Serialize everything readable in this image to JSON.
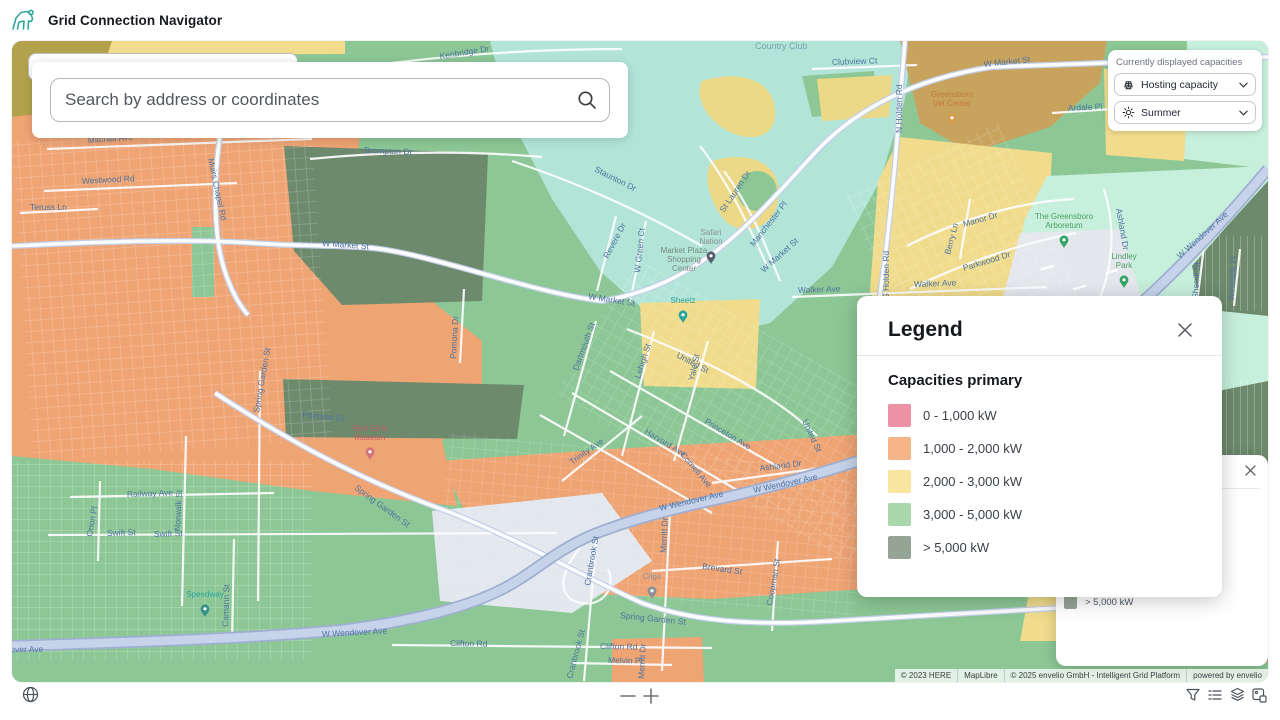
{
  "header": {
    "title": "Grid Connection Navigator",
    "brand_color": "#2fa99e"
  },
  "search": {
    "placeholder": "Search by address or coordinates"
  },
  "capacity_panel": {
    "label": "Currently displayed capacities",
    "dropdowns": [
      {
        "icon": "solar-panel-icon",
        "label": "Hosting capacity"
      },
      {
        "icon": "sun-icon",
        "label": "Summer"
      }
    ]
  },
  "legend": {
    "title": "Legend",
    "section": "Capacities primary",
    "items": [
      {
        "label": "0 - 1,000 kW",
        "color": "#ec92a4"
      },
      {
        "label": "1,000 - 2,000 kW",
        "color": "#f6b588"
      },
      {
        "label": "2,000 - 3,000 kW",
        "color": "#f8e69e"
      },
      {
        "label": "3,000 - 5,000 kW",
        "color": "#a9d8ac"
      },
      {
        "label": "> 5,000 kW",
        "color": "#96a496"
      }
    ]
  },
  "legend_back": {
    "item": {
      "label": "> 5,000 kW",
      "color": "#96a496"
    }
  },
  "attribution": {
    "items": [
      "© 2023 HERE",
      "MapLibre",
      "© 2025 envelio GmbH - Intelligent Grid Platform",
      "powered by envelio"
    ]
  },
  "map": {
    "road_labels": [
      {
        "t": "Mitchell Ave",
        "x": 76,
        "y": 102,
        "r": -4
      },
      {
        "t": "Westwood Rd",
        "x": 70,
        "y": 143,
        "r": -3
      },
      {
        "t": "Teruss Ln",
        "x": 18,
        "y": 169,
        "r": 0
      },
      {
        "t": "Muirs Chapel Rd",
        "x": 196,
        "y": 118,
        "r": 78
      },
      {
        "t": "Brompton Dr",
        "x": 352,
        "y": 112,
        "r": 2
      },
      {
        "t": "Kenbridge Dr",
        "x": 428,
        "y": 18,
        "r": -9
      },
      {
        "t": "Clubview Ct",
        "x": 820,
        "y": 24,
        "r": -2
      },
      {
        "t": "N Holden Rd",
        "x": 890,
        "y": 92,
        "r": -90
      },
      {
        "t": "S Holden Rd",
        "x": 877,
        "y": 258,
        "r": -90
      },
      {
        "t": "W Market St",
        "x": 310,
        "y": 205,
        "r": 4
      },
      {
        "t": "W Market St",
        "x": 576,
        "y": 258,
        "r": 9
      },
      {
        "t": "W Market St",
        "x": 752,
        "y": 232,
        "r": -42
      },
      {
        "t": "W Market St",
        "x": 972,
        "y": 26,
        "r": -6
      },
      {
        "t": "Staunton Dr",
        "x": 582,
        "y": 130,
        "r": 27
      },
      {
        "t": "St Lauren Dr",
        "x": 712,
        "y": 172,
        "r": -56
      },
      {
        "t": "Manchester Pl",
        "x": 742,
        "y": 206,
        "r": -52
      },
      {
        "t": "Walker Ave",
        "x": 786,
        "y": 252,
        "r": -2
      },
      {
        "t": "Walker Ave",
        "x": 902,
        "y": 246,
        "r": -2
      },
      {
        "t": "Ardale Pl",
        "x": 1056,
        "y": 70,
        "r": -3
      },
      {
        "t": "Manor Dr",
        "x": 952,
        "y": 186,
        "r": -16
      },
      {
        "t": "Parkwood Dr",
        "x": 952,
        "y": 230,
        "r": -17
      },
      {
        "t": "Berry Ln",
        "x": 938,
        "y": 214,
        "r": -75
      },
      {
        "t": "Ashland Dr",
        "x": 1104,
        "y": 168,
        "r": 80
      },
      {
        "t": "Ashland Dr",
        "x": 748,
        "y": 430,
        "r": -7
      },
      {
        "t": "W Wendover Ave",
        "x": 1168,
        "y": 218,
        "r": -42
      },
      {
        "t": "W Wendover Ave",
        "x": 742,
        "y": 452,
        "r": -12
      },
      {
        "t": "W Wendover Ave",
        "x": 648,
        "y": 470,
        "r": -13
      },
      {
        "t": "W Wendover Ave",
        "x": 310,
        "y": 596,
        "r": -3
      },
      {
        "t": "W Wendover Ave",
        "x": -34,
        "y": 612,
        "r": -1
      },
      {
        "t": "Spring Garden St",
        "x": 247,
        "y": 372,
        "r": -80
      },
      {
        "t": "Spring Garden St",
        "x": 342,
        "y": 448,
        "r": 36
      },
      {
        "t": "Spring Garden St",
        "x": 608,
        "y": 577,
        "r": 6
      },
      {
        "t": "Pomona Dr",
        "x": 444,
        "y": 318,
        "r": -87
      },
      {
        "t": "Pomona Dr",
        "x": 290,
        "y": 376,
        "r": 6
      },
      {
        "t": "Railway Ave",
        "x": 115,
        "y": 456,
        "r": -2
      },
      {
        "t": "Swift St",
        "x": 95,
        "y": 495,
        "r": -2
      },
      {
        "t": "Swift St",
        "x": 142,
        "y": 496,
        "r": -2
      },
      {
        "t": "Norwalk St",
        "x": 168,
        "y": 490,
        "r": -87
      },
      {
        "t": "Orion Pl",
        "x": 80,
        "y": 496,
        "r": -80
      },
      {
        "t": "Camann St",
        "x": 216,
        "y": 586,
        "r": -88
      },
      {
        "t": "United St",
        "x": 664,
        "y": 316,
        "r": 28
      },
      {
        "t": "United St",
        "x": 790,
        "y": 380,
        "r": 65
      },
      {
        "t": "Princeton Ave",
        "x": 692,
        "y": 382,
        "r": 31
      },
      {
        "t": "Harvard Ave",
        "x": 632,
        "y": 392,
        "r": 31
      },
      {
        "t": "Cornell Ave",
        "x": 668,
        "y": 414,
        "r": 50
      },
      {
        "t": "Lehigh St",
        "x": 628,
        "y": 338,
        "r": -72
      },
      {
        "t": "Yale St",
        "x": 682,
        "y": 340,
        "r": -78
      },
      {
        "t": "Dartmouth St",
        "x": 566,
        "y": 330,
        "r": -70
      },
      {
        "t": "Trinity Ave",
        "x": 560,
        "y": 424,
        "r": -35
      },
      {
        "t": "Merritt Dr",
        "x": 654,
        "y": 512,
        "r": -87
      },
      {
        "t": "Merritt Dr",
        "x": 632,
        "y": 638,
        "r": -87
      },
      {
        "t": "Brevard St",
        "x": 690,
        "y": 528,
        "r": 8
      },
      {
        "t": "Coopman St",
        "x": 760,
        "y": 565,
        "r": -80
      },
      {
        "t": "Cranbrook St",
        "x": 578,
        "y": 545,
        "r": -80
      },
      {
        "t": "Cranbrook St",
        "x": 560,
        "y": 638,
        "r": -75
      },
      {
        "t": "Clifton Rd",
        "x": 438,
        "y": 605,
        "r": 1
      },
      {
        "t": "Clifton Rd",
        "x": 588,
        "y": 608,
        "r": 1
      },
      {
        "t": "Melvin Pl",
        "x": 596,
        "y": 622,
        "r": 1
      },
      {
        "t": "Revere Dr",
        "x": 596,
        "y": 218,
        "r": -62
      },
      {
        "t": "W Green Ct",
        "x": 628,
        "y": 232,
        "r": -84
      },
      {
        "t": "Sherrill St",
        "x": 1186,
        "y": 258,
        "r": -87
      },
      {
        "t": "Westside Pl",
        "x": 1222,
        "y": 260,
        "r": -87
      }
    ],
    "area_labels": [
      {
        "t": "Country Club",
        "x": 743,
        "y": 8,
        "c": "#79a0ad",
        "s": 9
      }
    ],
    "pois": [
      {
        "lines": [
          "Safari",
          "Nation"
        ],
        "x": 699,
        "y": 194,
        "c": "#8a9097",
        "pin": "#555f6b"
      },
      {
        "lines": [
          "Market Plaza",
          "Shopping",
          "Center"
        ],
        "x": 672,
        "y": 212,
        "c": "#74897b",
        "pin": ""
      },
      {
        "lines": [
          "Sheetz"
        ],
        "x": 671,
        "y": 262,
        "c": "#2ba39c",
        "pin": "#2ba39c"
      },
      {
        "lines": [
          "Rich Girls",
          "Museum"
        ],
        "x": 358,
        "y": 390,
        "c": "#c45b64",
        "pin": "#d2737c"
      },
      {
        "lines": [
          "Speedway"
        ],
        "x": 193,
        "y": 556,
        "c": "#2ba39c",
        "pin": "#3a8f89"
      },
      {
        "lines": [
          "Greensboro",
          "Vet Center"
        ],
        "x": 940,
        "y": 56,
        "c": "#c07a3a",
        "pin": "#d79b4a"
      },
      {
        "lines": [
          "The Greensboro",
          "Arboretum"
        ],
        "x": 1052,
        "y": 178,
        "c": "#4d9e62",
        "pin": "#35a367"
      },
      {
        "lines": [
          "Lindley",
          "Park"
        ],
        "x": 1112,
        "y": 218,
        "c": "#4d9e62",
        "pin": "#35a367"
      },
      {
        "lines": [
          "Citgo"
        ],
        "x": 640,
        "y": 538,
        "c": "#8a9097",
        "pin": "#8a9097"
      }
    ]
  }
}
